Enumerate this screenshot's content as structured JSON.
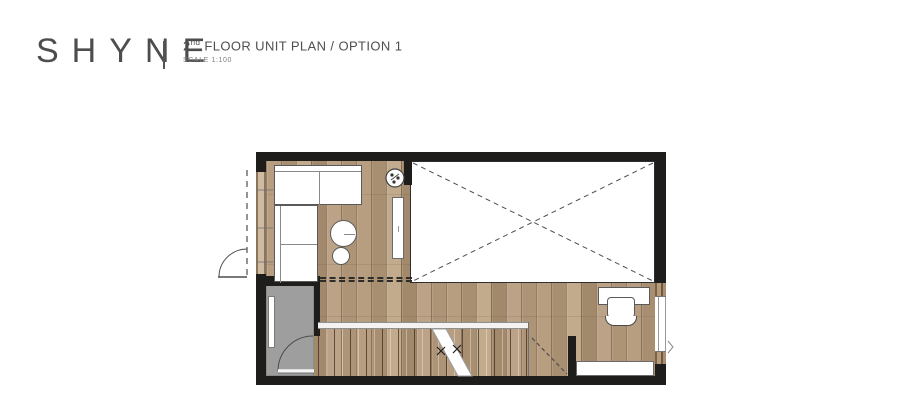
{
  "header": {
    "brand": "SHYNE",
    "plan_title_number": "2",
    "plan_title_ordinal": "nd",
    "plan_title_rest": " FLOOR UNIT PLAN / OPTION 1",
    "scale_label": "SCALE 1:100"
  },
  "floorplan": {
    "description": "2nd floor unit plan, option 1: living area with L-sofa beside balcony door, double-height void open to below, staircase going down, bathroom with inswing door, and study nook with desk, chair and low cabinet",
    "colors": {
      "wall": "#1e1d1b",
      "wood_base": "#b3997b",
      "bath_floor": "#9e9e9e",
      "void_fill": "#ffffff",
      "furniture_fill": "#ffffff",
      "furniture_stroke": "#5a5a5a",
      "line": "#4d4d4d"
    },
    "rooms": [
      {
        "name": "living-area",
        "floor": "wood"
      },
      {
        "name": "void-open-to-below",
        "floor": "none"
      },
      {
        "name": "stair-hallway",
        "floor": "wood"
      },
      {
        "name": "bathroom",
        "floor": "gray"
      },
      {
        "name": "study-nook",
        "floor": "wood"
      }
    ],
    "furniture": [
      "l-shaped-sofa",
      "coffee-table",
      "stool",
      "potted-plant",
      "tv-console",
      "staircase",
      "desk",
      "desk-chair",
      "low-cabinet",
      "bath-shelf"
    ]
  }
}
